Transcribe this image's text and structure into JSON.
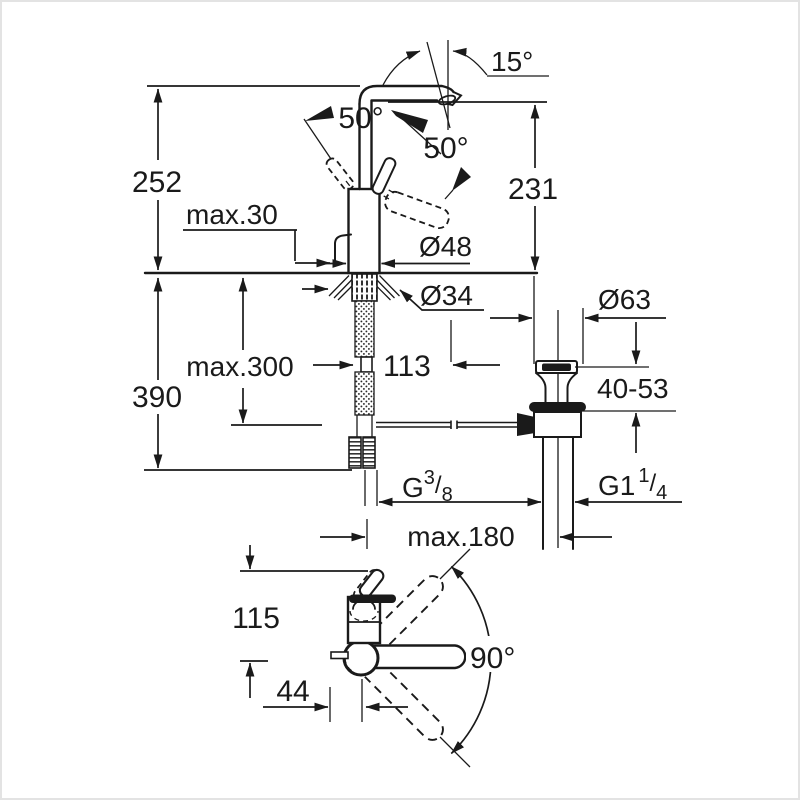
{
  "colors": {
    "ink": "#1a1a1a",
    "background": "#ffffff",
    "frame": "#e3e3e3"
  },
  "labels": {
    "spout_tilt_angle": "15°",
    "lever_swing_side": "50°",
    "lever_swing_front": "50°",
    "total_height": "252",
    "spout_height": "231",
    "deck_thickness_max": "max.30",
    "body_diameter": "Ø48",
    "shank_diameter": "Ø34",
    "drain_flange_diameter": "Ø63",
    "hose_length_max": "max.300",
    "supply_drop": "390",
    "spout_reach": "113",
    "drain_clamp_range": "40-53",
    "supply_thread": {
      "prefix": "G",
      "sup": "3",
      "slash": "/",
      "sub": "8"
    },
    "drain_thread": {
      "prefix": "G1",
      "sup": "1",
      "slash": "/",
      "sub": "4"
    },
    "rod_reach_max": "max.180",
    "base_depth": "115",
    "rod_offset": "44",
    "swivel_angle": "90°"
  }
}
